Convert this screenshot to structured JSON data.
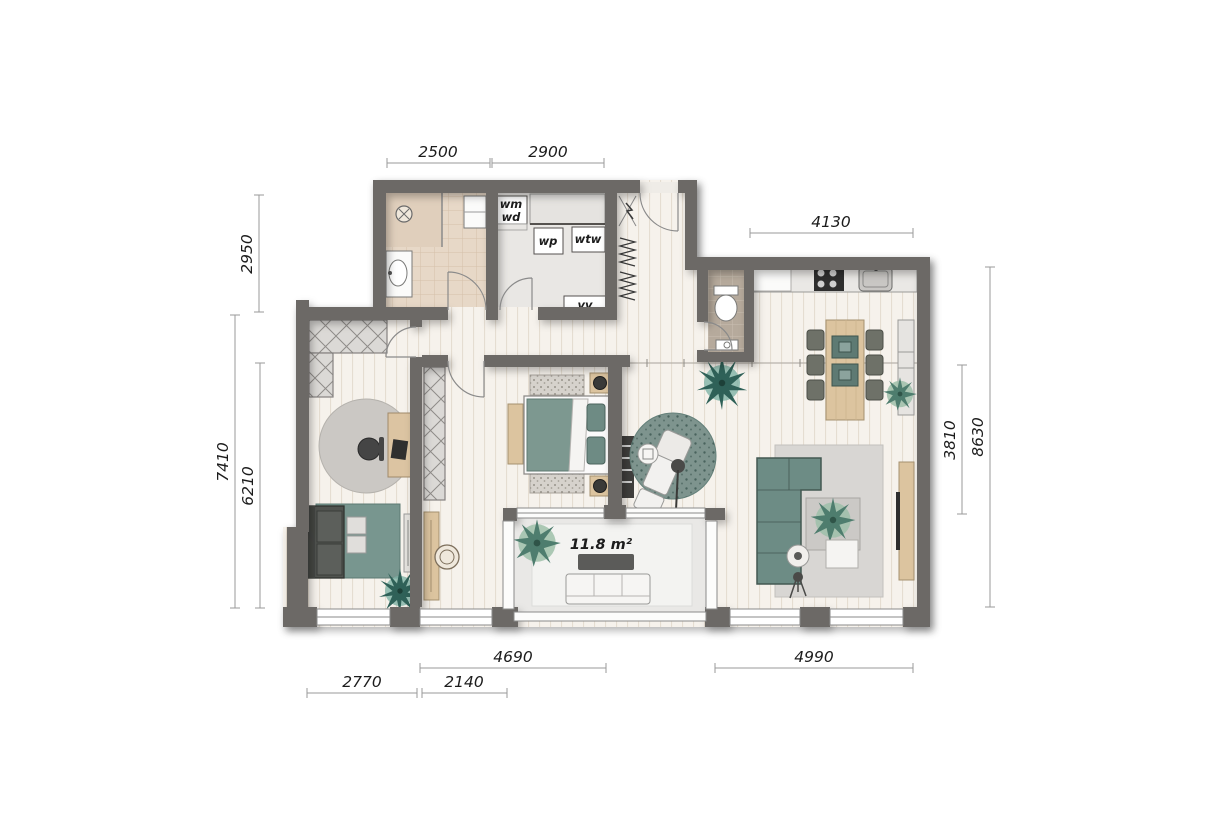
{
  "title": "apartment floor plan",
  "dimensions": {
    "top": {
      "bathroom": "2500",
      "utility": "2900",
      "kitchen": "4130"
    },
    "left": {
      "bathroom_depth": "2950",
      "total_depth": "7410",
      "rooms_depth": "6210"
    },
    "right": {
      "living_depth": "3810",
      "total_depth": "8630"
    },
    "bottom": {
      "bedroom": "4690",
      "study": "2770",
      "bedroom_alcove": "2140",
      "living": "4990"
    }
  },
  "labels": {
    "wm": "wm",
    "wd": "wd",
    "wp": "wp",
    "wtw": "wtw",
    "vv": "vv",
    "balcony_area": "11.8 m²"
  },
  "colors": {
    "wall": "#6c6966",
    "floor": "#f6f2ec",
    "bath_tile": "#e7d8c7",
    "wc_tile": "#b6aa9c",
    "utility_floor": "#e9e7e4",
    "balcony_floor": "#e9e8e6",
    "accent_teal": "#6d8c85",
    "rug_gray": "#d8d6d3",
    "wood": "#dcc49f",
    "plant_green": "#4e7d6e",
    "plant_teal": "#2f6158",
    "dim_line": "#9a9a9a",
    "text": "#1c1c1c"
  }
}
